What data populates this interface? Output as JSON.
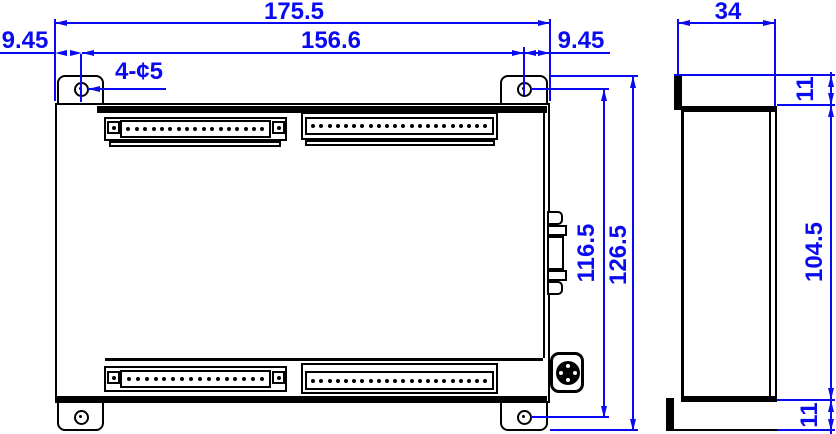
{
  "drawing": {
    "front_view": {
      "dim_overall_width": "175.5",
      "dim_hole_span_width": "156.6",
      "dim_left_hole_offset": "9.45",
      "dim_right_hole_offset": "9.45",
      "hole_callout": "4-¢5",
      "dim_hole_span_height": "116.5",
      "dim_overall_height": "126.5",
      "terminal_blocks": {
        "top_left_count": 17,
        "top_right_count": 22,
        "bottom_left_count": 16,
        "bottom_right_count": 22
      }
    },
    "side_view": {
      "dim_depth": "34",
      "dim_top_flange": "11",
      "dim_body_height": "104.5",
      "dim_bottom_flange": "11"
    },
    "colors": {
      "dimension_blue": "#0a0af2",
      "line_black": "#000000"
    }
  }
}
